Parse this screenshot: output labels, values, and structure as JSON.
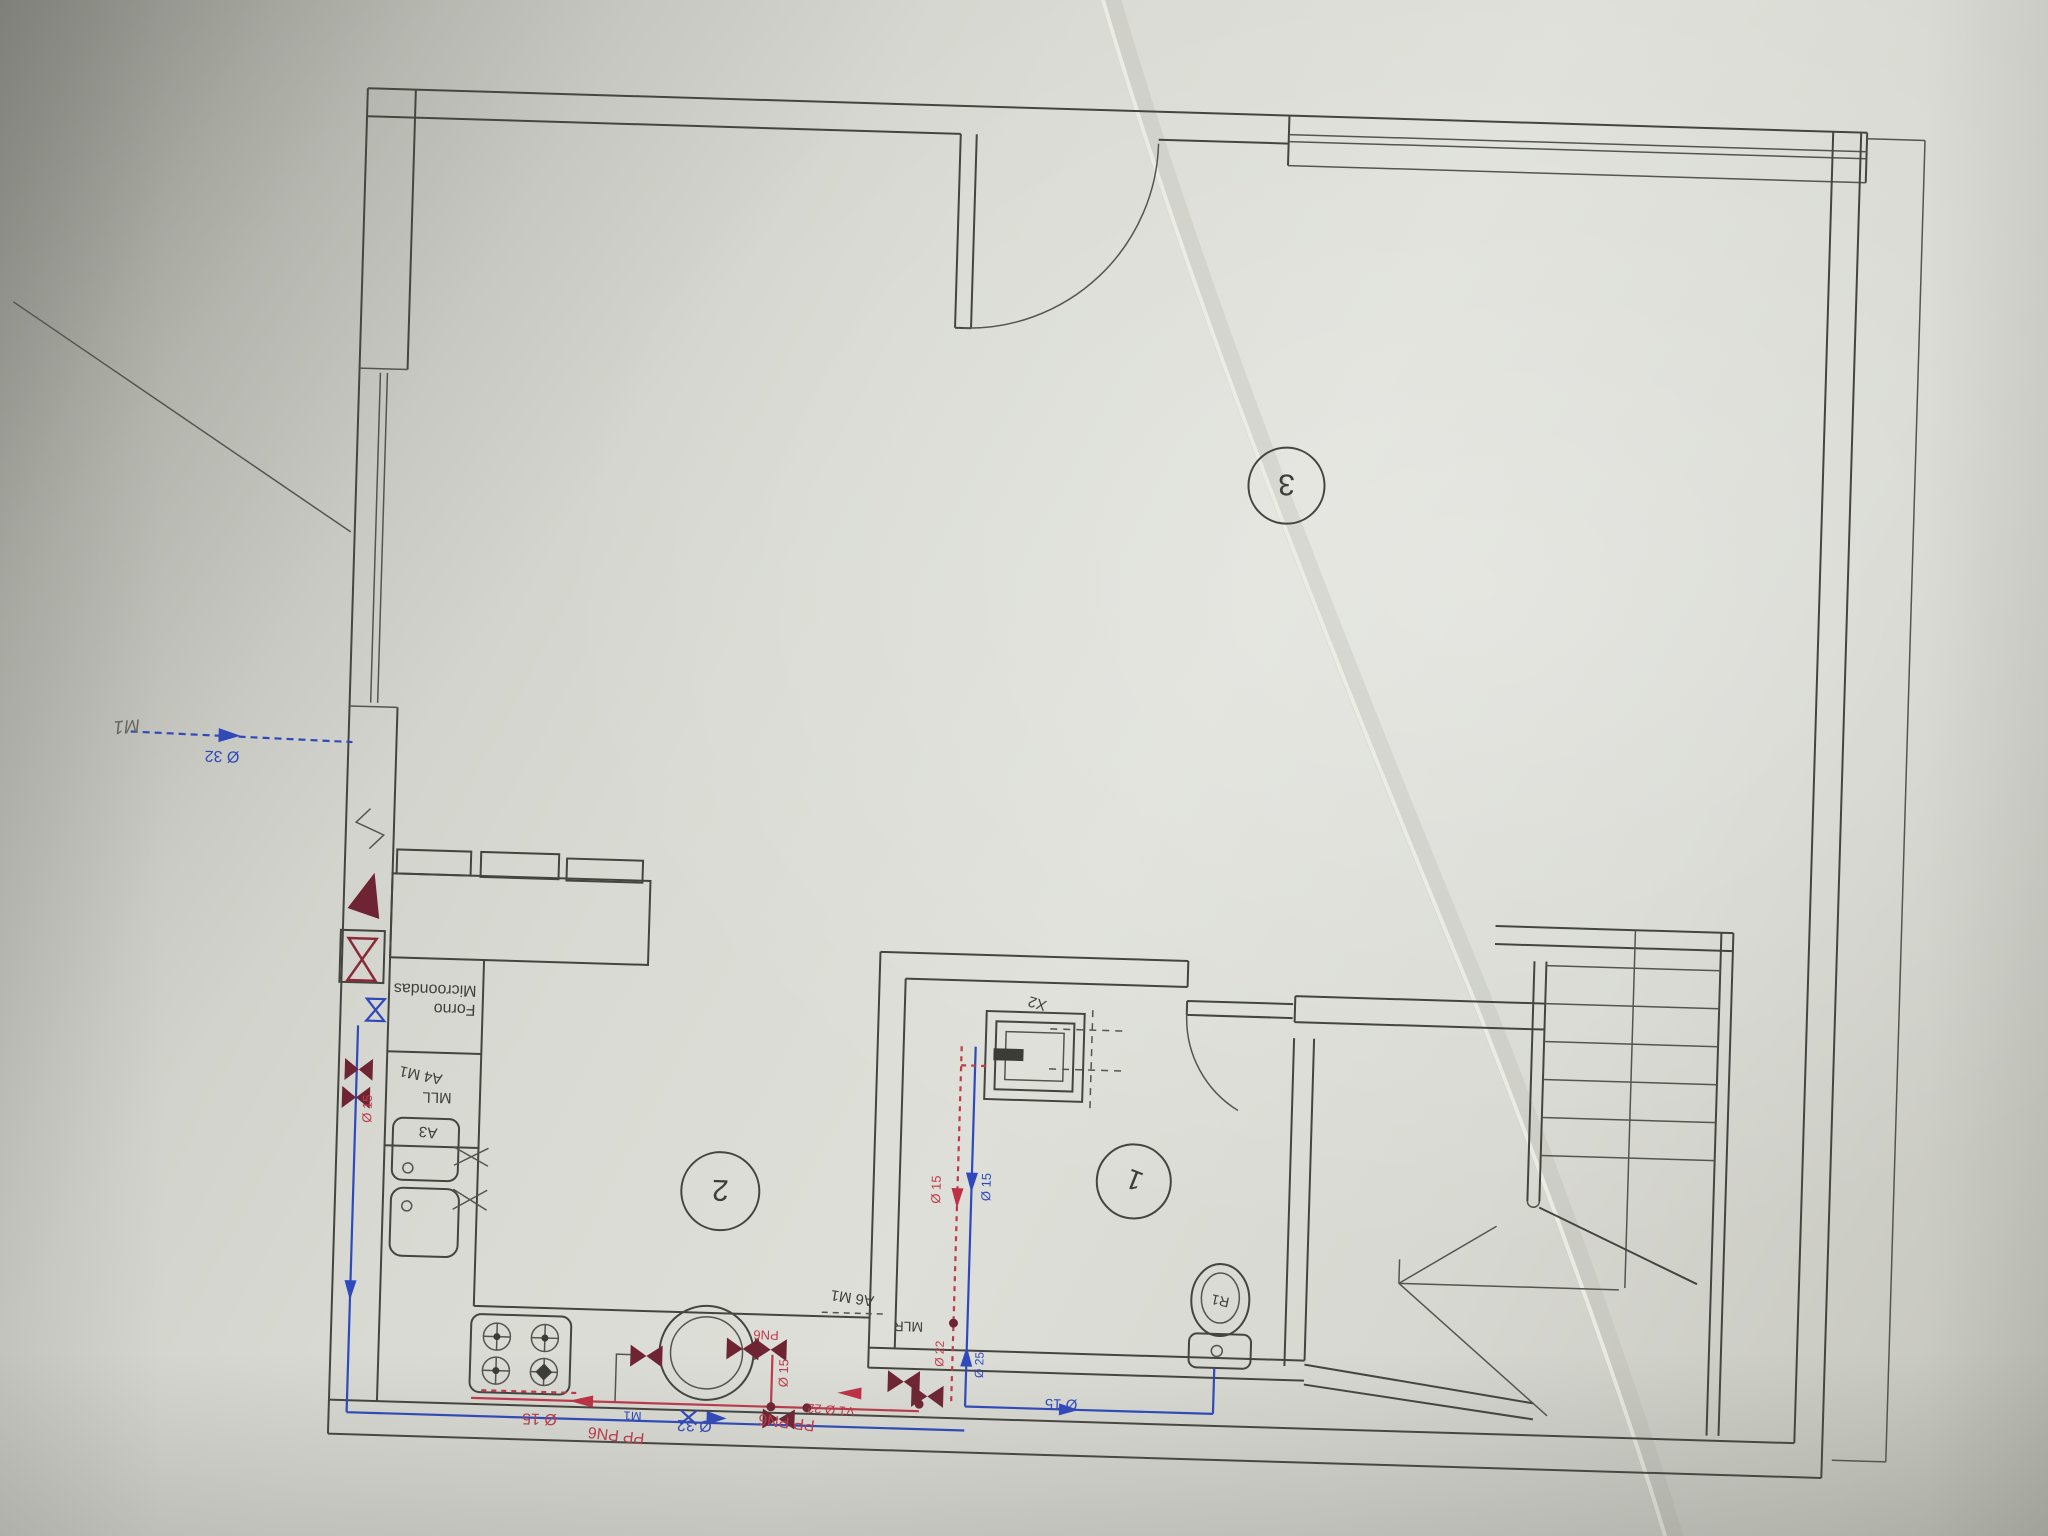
{
  "document": {
    "kind": "hand-annotated floor plan photo",
    "orientation": "drawing appears upside-down (rotated 180°)"
  },
  "colors": {
    "paper": "#d9dad3",
    "ink": "#45453f",
    "cold_water_blue": "#2f49bd",
    "hot_water_red": "#bf3a4b",
    "valve_dark_red": "#6e2433",
    "pencil": "#696b63"
  },
  "plan": {
    "rooms": {
      "kitchen_number": "2",
      "wc_number": "1",
      "living_number": "3"
    },
    "kitchen": {
      "oven": "Forno",
      "microwave": "Microondas",
      "dishwasher": "MLL",
      "point_a4": "A4 M1",
      "sink": "A3"
    },
    "wc": {
      "shower": "X2",
      "toilet": "R1"
    },
    "laundry": {
      "point_a6": "A6 M1",
      "washer": "MLR"
    },
    "pencil_note": {
      "meter": "M1"
    },
    "cold_water": {
      "main_inlet": "Ø 32",
      "kitchen_main": "Ø 32",
      "meter_valve": "M1",
      "cistern_branch": "Ø 15",
      "wc_riser": "Ø 15",
      "shower_riser": "Ø 25"
    },
    "hot_water": {
      "kitchen_line": "Ø 15",
      "boiler_out": "Ø 15",
      "boiler_grade": "PN6",
      "pipe_label_a": "PP PN6",
      "pipe_label_b": "PP PN6",
      "valve_v1": "V1 Ø 22",
      "wc_riser": "Ø 15",
      "shower_riser": "Ø 22",
      "wall_riser": "Ø 15"
    }
  }
}
